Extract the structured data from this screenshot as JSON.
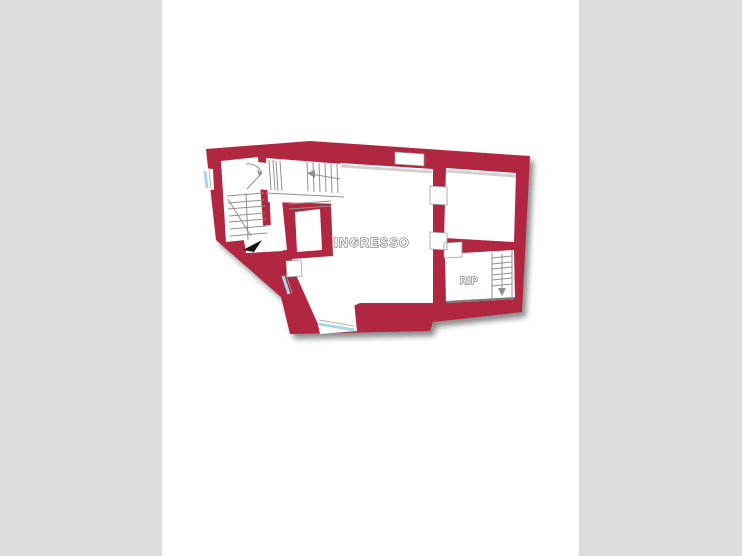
{
  "canvas": {
    "width": 742,
    "height": 556,
    "page_bg": "#ffffff",
    "letterbox_color": "#dcdcdc"
  },
  "floor_plan": {
    "wall_color": "#b12741",
    "window_color": "#a5d9ea",
    "thin_line_color": "#8f8f8f",
    "label_fill": "#ffffff",
    "label_outline": "#4a4a4a",
    "entrance_arrow_color": "#151515",
    "labels": {
      "main_room": "INGRESSO",
      "storage_room": "RIP"
    }
  }
}
